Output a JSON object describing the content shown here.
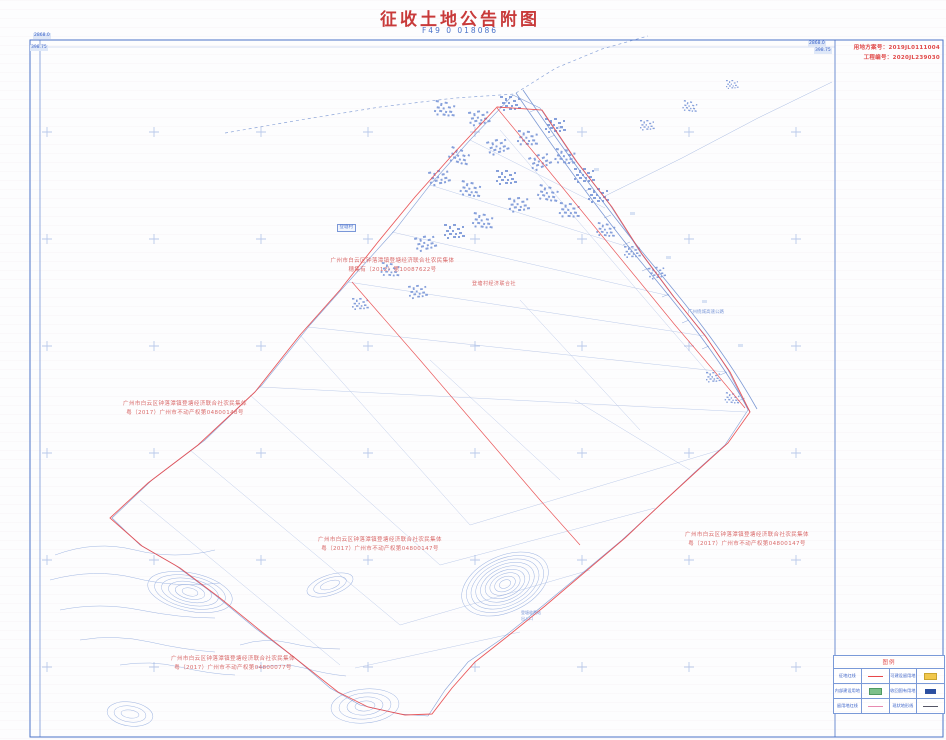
{
  "header": {
    "title": "征收土地公告附图",
    "sheet_no": "F49 0 018086"
  },
  "title_block": {
    "plan_no": "用地方案号：2019JL0111004",
    "project_no": "工程编号：2020JL239030"
  },
  "grid_labels": {
    "top_left_northing": "2868.0",
    "top_left_easting": "398.75",
    "top_right_northing": "2868.0",
    "top_right_easting": "398.75"
  },
  "annotations": [
    {
      "line1": "广州市白云区钟落潭镇登塘经济联合社农民集体",
      "line2": "穗集有（2012）第10087622号"
    },
    {
      "line1": "广州市白云区钟落潭镇登塘经济联合社农民集体",
      "line2": "粤（2017）广州市不动产权第04800148号"
    },
    {
      "line1": "广州市白云区钟落潭镇登塘经济联合社农民集体",
      "line2": "粤（2017）广州市不动产权第04800147号"
    },
    {
      "line1": "广州市白云区钟落潭镇登塘经济联合社农民集体",
      "line2": "粤（2017）广州市不动产权第04800147号"
    },
    {
      "line1": "广州市白云区钟落潭镇登塘经济联合社农民集体",
      "line2": "粤（2017）广州市不动产权第04800077号"
    }
  ],
  "map_labels": {
    "village_committee": "登塘村经济联合社",
    "village": "登塘村",
    "highway": "广州绕城高速公路",
    "station_line1": "登塘收费站",
    "station_line2": "出入口"
  },
  "legend": {
    "title": "图例",
    "rows": [
      [
        {
          "label": "征地红线",
          "symbol": "red-line"
        },
        {
          "label": "可建设留用地",
          "symbol": "yellow-fill"
        }
      ],
      [
        {
          "label": "内部建设用地",
          "symbol": "green-fill"
        },
        {
          "label": "收回国有用地",
          "symbol": "blue-fill"
        }
      ],
      [
        {
          "label": "留用地红线",
          "symbol": "pink-line"
        },
        {
          "label": "现状地形线",
          "symbol": "dark-dash"
        }
      ]
    ]
  },
  "colors": {
    "title_red": "#c83a3a",
    "annotation_red": "#d96a6a",
    "boundary_red": "#e8474a",
    "map_blue": "#6f8fd0",
    "frame_blue": "#4a72c8",
    "legend_yellow": "#f2c84b",
    "legend_green": "#7cc08a",
    "legend_blue": "#2b4fa0"
  }
}
